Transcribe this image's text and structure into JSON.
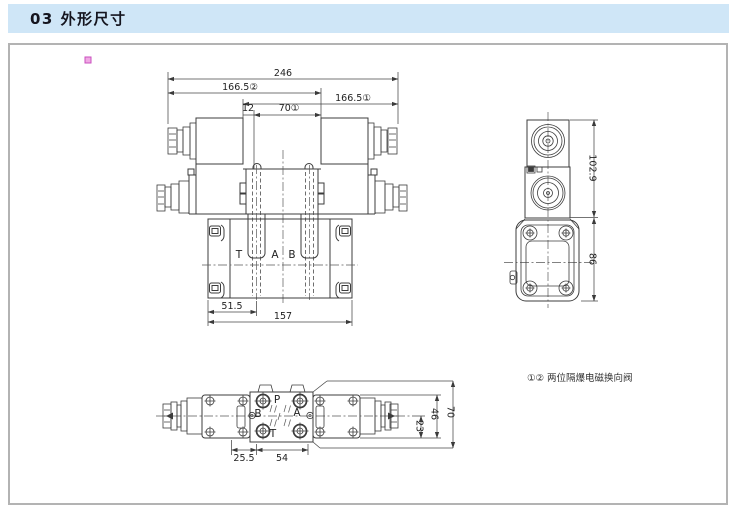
{
  "header": {
    "title": "03 外形尺寸"
  },
  "front": {
    "dims": {
      "overall": "246",
      "stroke_left": "166.5②",
      "stroke_right": "166.5①",
      "offset": "12",
      "spool": "70①",
      "port_center": "51.5",
      "plate_width": "157"
    },
    "ports": {
      "t": "T",
      "a": "A",
      "b": "B"
    }
  },
  "side": {
    "dims": {
      "upper_height": "102.9",
      "lower_height": "86"
    }
  },
  "top": {
    "dims": {
      "edge_to_port": "25.5",
      "port_span": "54",
      "half_width": "23",
      "plate_width": "46",
      "overall_width": "70"
    },
    "ports": {
      "p": "P",
      "a": "A",
      "b": "B",
      "t": "T"
    }
  },
  "note": {
    "text": "①② 两位隔爆电磁换向阀"
  },
  "colors": {
    "header_bg": "#cfe6f7",
    "line": "#3c3c3c",
    "frame_border": "#b3b3b3",
    "marker_pink": "#f0a8e4"
  }
}
